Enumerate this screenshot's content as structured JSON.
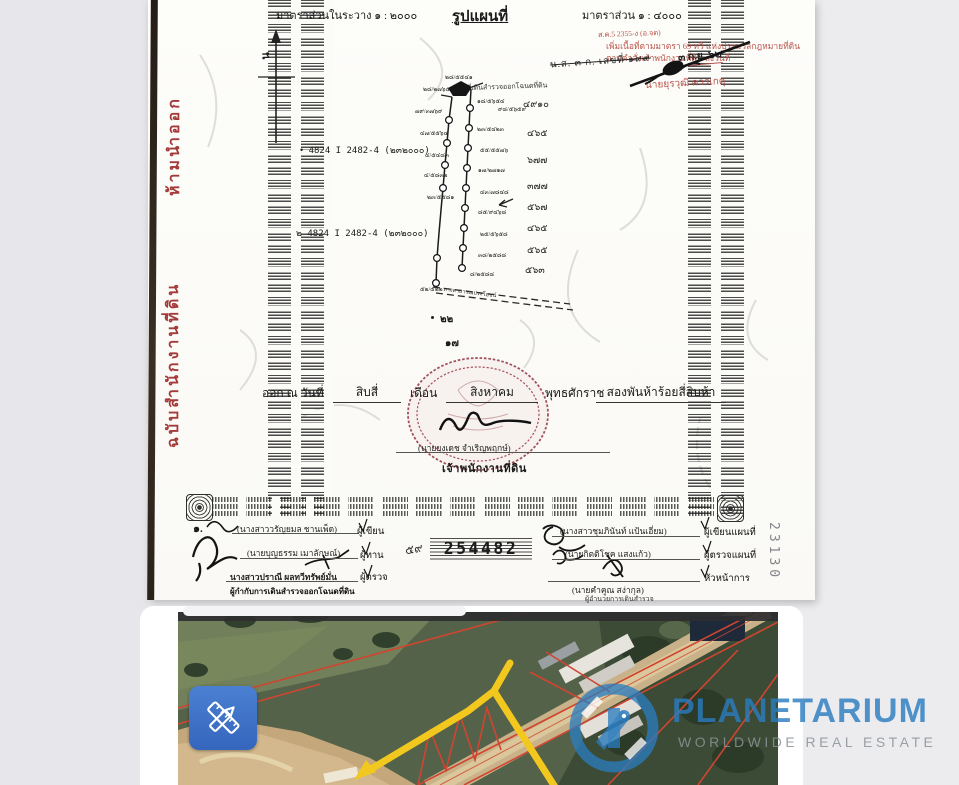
{
  "deed": {
    "side_label_top": "ห้ามนำออก",
    "side_label_bottom": "ฉบับสำนักงานที่ดิน",
    "scale_left": "มาตราส่วนในระวาง ๑ : ๒๐๐๐",
    "title": "รูปแผนที่",
    "scale_right": "มาตราส่วน ๑ : ๔๐๐๐",
    "north_label": "น",
    "stamp": {
      "ref_small": "ส.ค.5 2355-ง (อ.จด)",
      "line1": "เพิ่มเนื้อที่ตามมาตรา 69 ทวิ แห่งประมวลกฎหมายที่ดิน",
      "line2": "ตามคำสั่งเจ้าพนักงานที่ดิน ลงวันที่",
      "date_stamp": "๓ ก.ย. ๖๒",
      "signer": "นายยุรวุฒิ ควรเกตุ"
    },
    "doc_no": "น.ส. ๓ ก. เลขที่ ๑๙๙",
    "survey_note": "แปลงที่เดินสำรวจออกโฉนดที่ดิน",
    "ref_marker1": "•",
    "ref1": "4824 I 2482-4 (๒๓๒๐๐๐)",
    "ref_marker2": "๒",
    "ref2": "4824 I 2482-4 (๒๓๒๐๐๐)",
    "road_label": "ทางสาธารณประโยชน์",
    "labels_top": [
      "๒๘/๒๗๖๕",
      "๒๘/๕๕๔๑",
      "๑๘/๕๖๕๔",
      "๙๘/๕๖๕๙"
    ],
    "labels_left": [
      "๗๙/๓๗๖๙",
      "๔๗/๕๕๖๔",
      "๔/๕๔๘๓",
      "๔/๕๘๓๒",
      "๒๓/๕๕๘๑",
      "๕๒/๕๒๒"
    ],
    "labels_right": [
      "๒๓/๕๔๒๓",
      "๕๕/๕๕๗๖",
      "๑๗/๒๗๑๗",
      "๔๓/๗๘๔๘",
      "๘๕/๙๔๖๘",
      "๒๕/๕๖๕๘",
      "๓๘/๒๕๘๘",
      "๘/๒๕๘๘"
    ],
    "neighbors": [
      "๔๙๑๐",
      "๔๖๕",
      "๖๗๗",
      "๓๗๗",
      "๕๖๗",
      "๔๖๕",
      "๕๖๕",
      "๕๖๓"
    ],
    "below_no1": "๒๒",
    "below_no2": "๑๗",
    "issue": {
      "p1": "ออก ณ วันที่",
      "day": "สิบสี่",
      "p2": "เดือน",
      "month": "สิงหาคม",
      "p3": "พุทธศักราช",
      "year": "สองพันห้าร้อยสี่สิบห้า"
    },
    "seal": {
      "name": "(นายยงเดช จำเริญพฤกษ์)",
      "role": "เจ้าพนักงานที่ดิน"
    },
    "sign_left": [
      {
        "prefix": "๑.",
        "name": "(นางสาววรัญยมล ชานเพ็ด)",
        "role": "ผู้เขียน"
      },
      {
        "name": "(นายบุญธรรม เมาลักษณ์)",
        "role": "ผู้ทาน"
      },
      {
        "name": "นางสาวปราณี ผลทวีทรัพย์มั่น",
        "role": "ผู้ตรวจ"
      }
    ],
    "left_footer": "ผู้กำกับการเดินสำรวจออกโฉนดที่ดิน",
    "serial_prefix": "๕๙",
    "serial": "254482",
    "sign_right": [
      {
        "name": "(นางสาวชุมภินันท์ แป้นเอี่ยม)",
        "role": "ผู้เขียนแผนที่"
      },
      {
        "name": "(นายกิตติโชค แสงแก้ว)",
        "role": "ผู้ตรวจแผนที่"
      },
      {
        "name": "(นายคำคูณ สง่ากุล)",
        "role": "หัวหน้าการ"
      }
    ],
    "right_footer": "ผู้อำนวยการเดินสำรวจ",
    "margin_number": "23130"
  },
  "photo": {
    "logo_brand": "PLANETARIUM",
    "logo_tagline": "WORLDWIDE REAL ESTATE",
    "colors": {
      "brand_blue": "#2a7cc0",
      "button_blue": "#3a6fc6",
      "boundary_yellow": "#f2c71e",
      "cadastral_red": "#cf4530"
    }
  }
}
